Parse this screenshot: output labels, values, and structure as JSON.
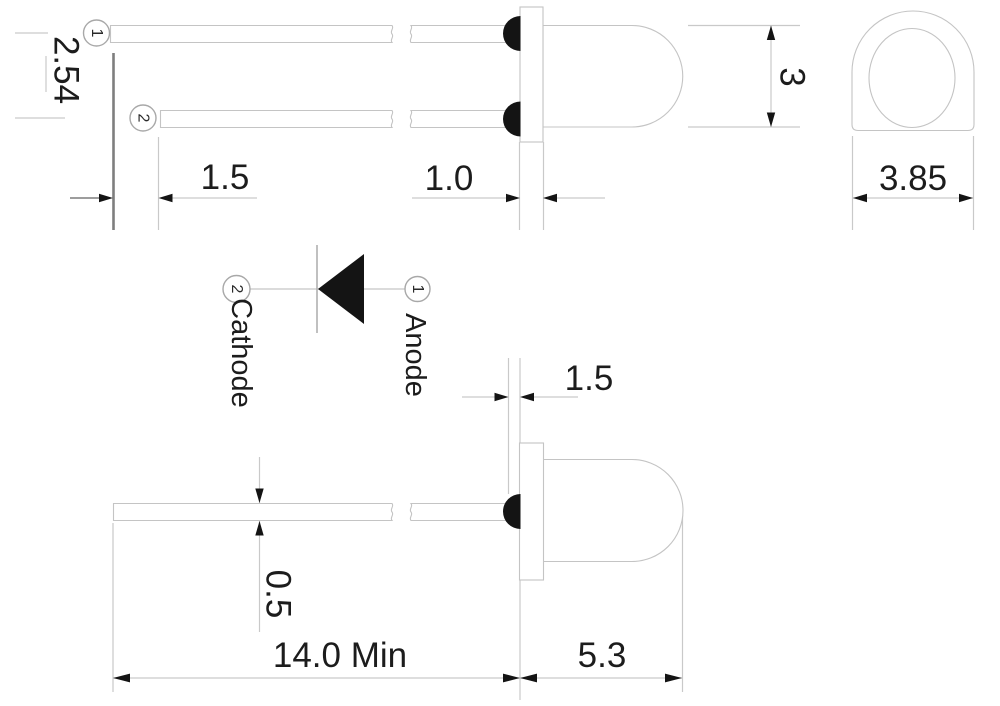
{
  "drawing": {
    "dims": {
      "lead_pitch": "2.54",
      "lead_offset": "1.5",
      "flange_thickness": "1.0",
      "body_diameter": "3",
      "flange_diameter": "3.85",
      "flange_standoff": "1.5",
      "lead_thickness": "0.5",
      "lead_length": "14.0 Min",
      "body_length": "5.3"
    },
    "pins": {
      "anode_number": "1",
      "cathode_number": "2"
    },
    "schematic": {
      "cathode_label": "Cathode",
      "anode_label": "Anode"
    },
    "colors": {
      "outline": "#c4c4c4",
      "extension": "#c9c9c9",
      "reference": "#7e7e7e",
      "ink": "#141414",
      "text": "#1c1c1c",
      "background": "#ffffff"
    }
  }
}
